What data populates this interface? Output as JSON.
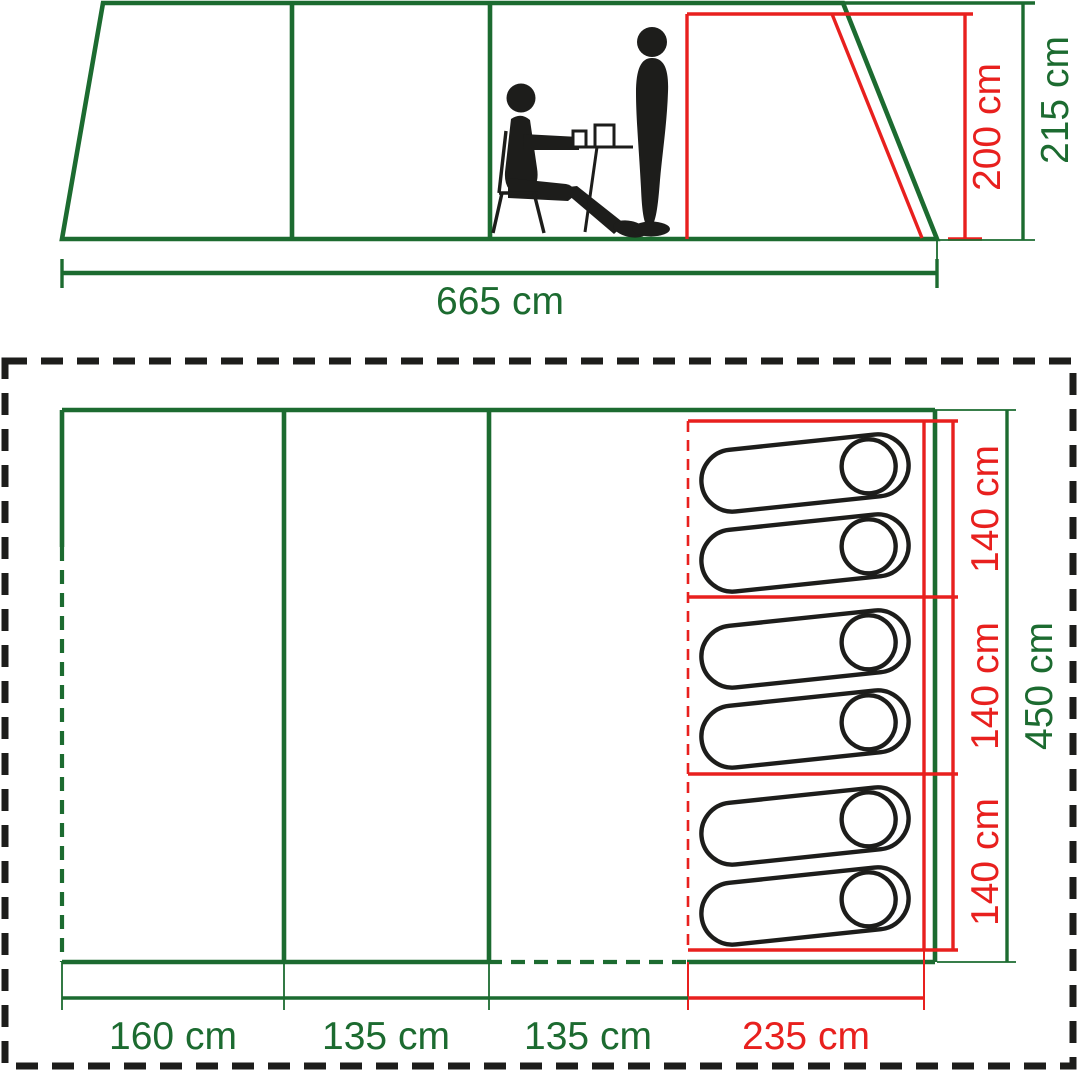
{
  "figure": {
    "type": "tent-dimension-diagram",
    "side_view": {
      "length_label": "665 cm",
      "inner_height_label": "200 cm",
      "outer_height_label": "215 cm"
    },
    "floor_plan": {
      "width_labels": [
        "160 cm",
        "135 cm",
        "135 cm",
        "235 cm"
      ],
      "depth_label": "450 cm",
      "bedroom_section_labels": [
        "140 cm",
        "140 cm",
        "140 cm"
      ],
      "sleeping_bag_count": 6
    },
    "colors": {
      "outline_green": "#1c6b30",
      "highlight_red": "#e8201e",
      "pictogram_black": "#1d1d1b"
    }
  }
}
